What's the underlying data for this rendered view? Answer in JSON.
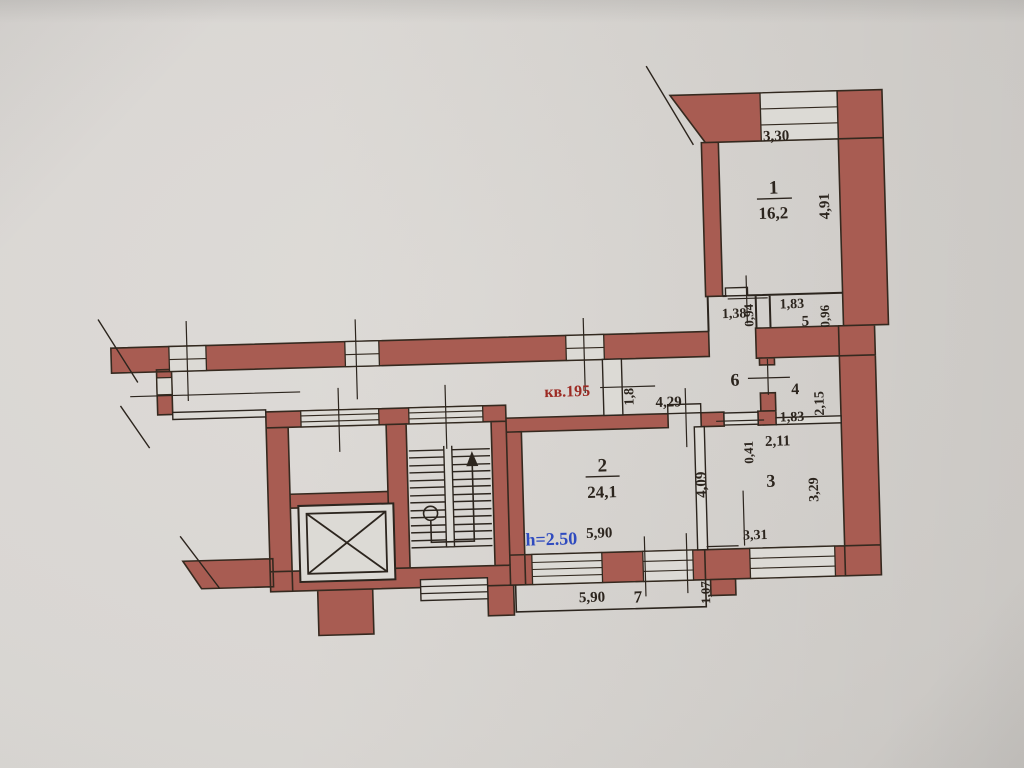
{
  "document_type": "apartment-floor-plan-photo",
  "colors": {
    "paper": "#d7d4d0",
    "wall_fill": "#a85c52",
    "ink": "#32291f",
    "apartment_label_red": "#9c2b24",
    "height_label_blue": "#2f4bbf"
  },
  "plan": {
    "apartment_label": "кв.195",
    "ceiling_height_label": "h=2.50",
    "rooms": {
      "r1": {
        "num": "1",
        "area": "16,2",
        "width": "3,30",
        "depth": "4,91"
      },
      "r2": {
        "num": "2",
        "area": "24,1",
        "width": "5,90",
        "depth": "4,09"
      },
      "r3": {
        "num": "3",
        "width": "3,31",
        "depth": "3,29",
        "door_width": "2,11",
        "door_offset": "0,41"
      },
      "r4": {
        "num": "4",
        "width": "1,83",
        "depth": "2,15"
      },
      "r5": {
        "num": "5",
        "width": "1,83",
        "depth": "0,96"
      },
      "r6": {
        "num": "6",
        "length": "4,29",
        "entry_width": "1,8"
      },
      "r7": {
        "num": "7",
        "width": "5,90",
        "depth": "1,07"
      },
      "lobby": {
        "width": "1,38",
        "depth": "0,94"
      }
    }
  }
}
